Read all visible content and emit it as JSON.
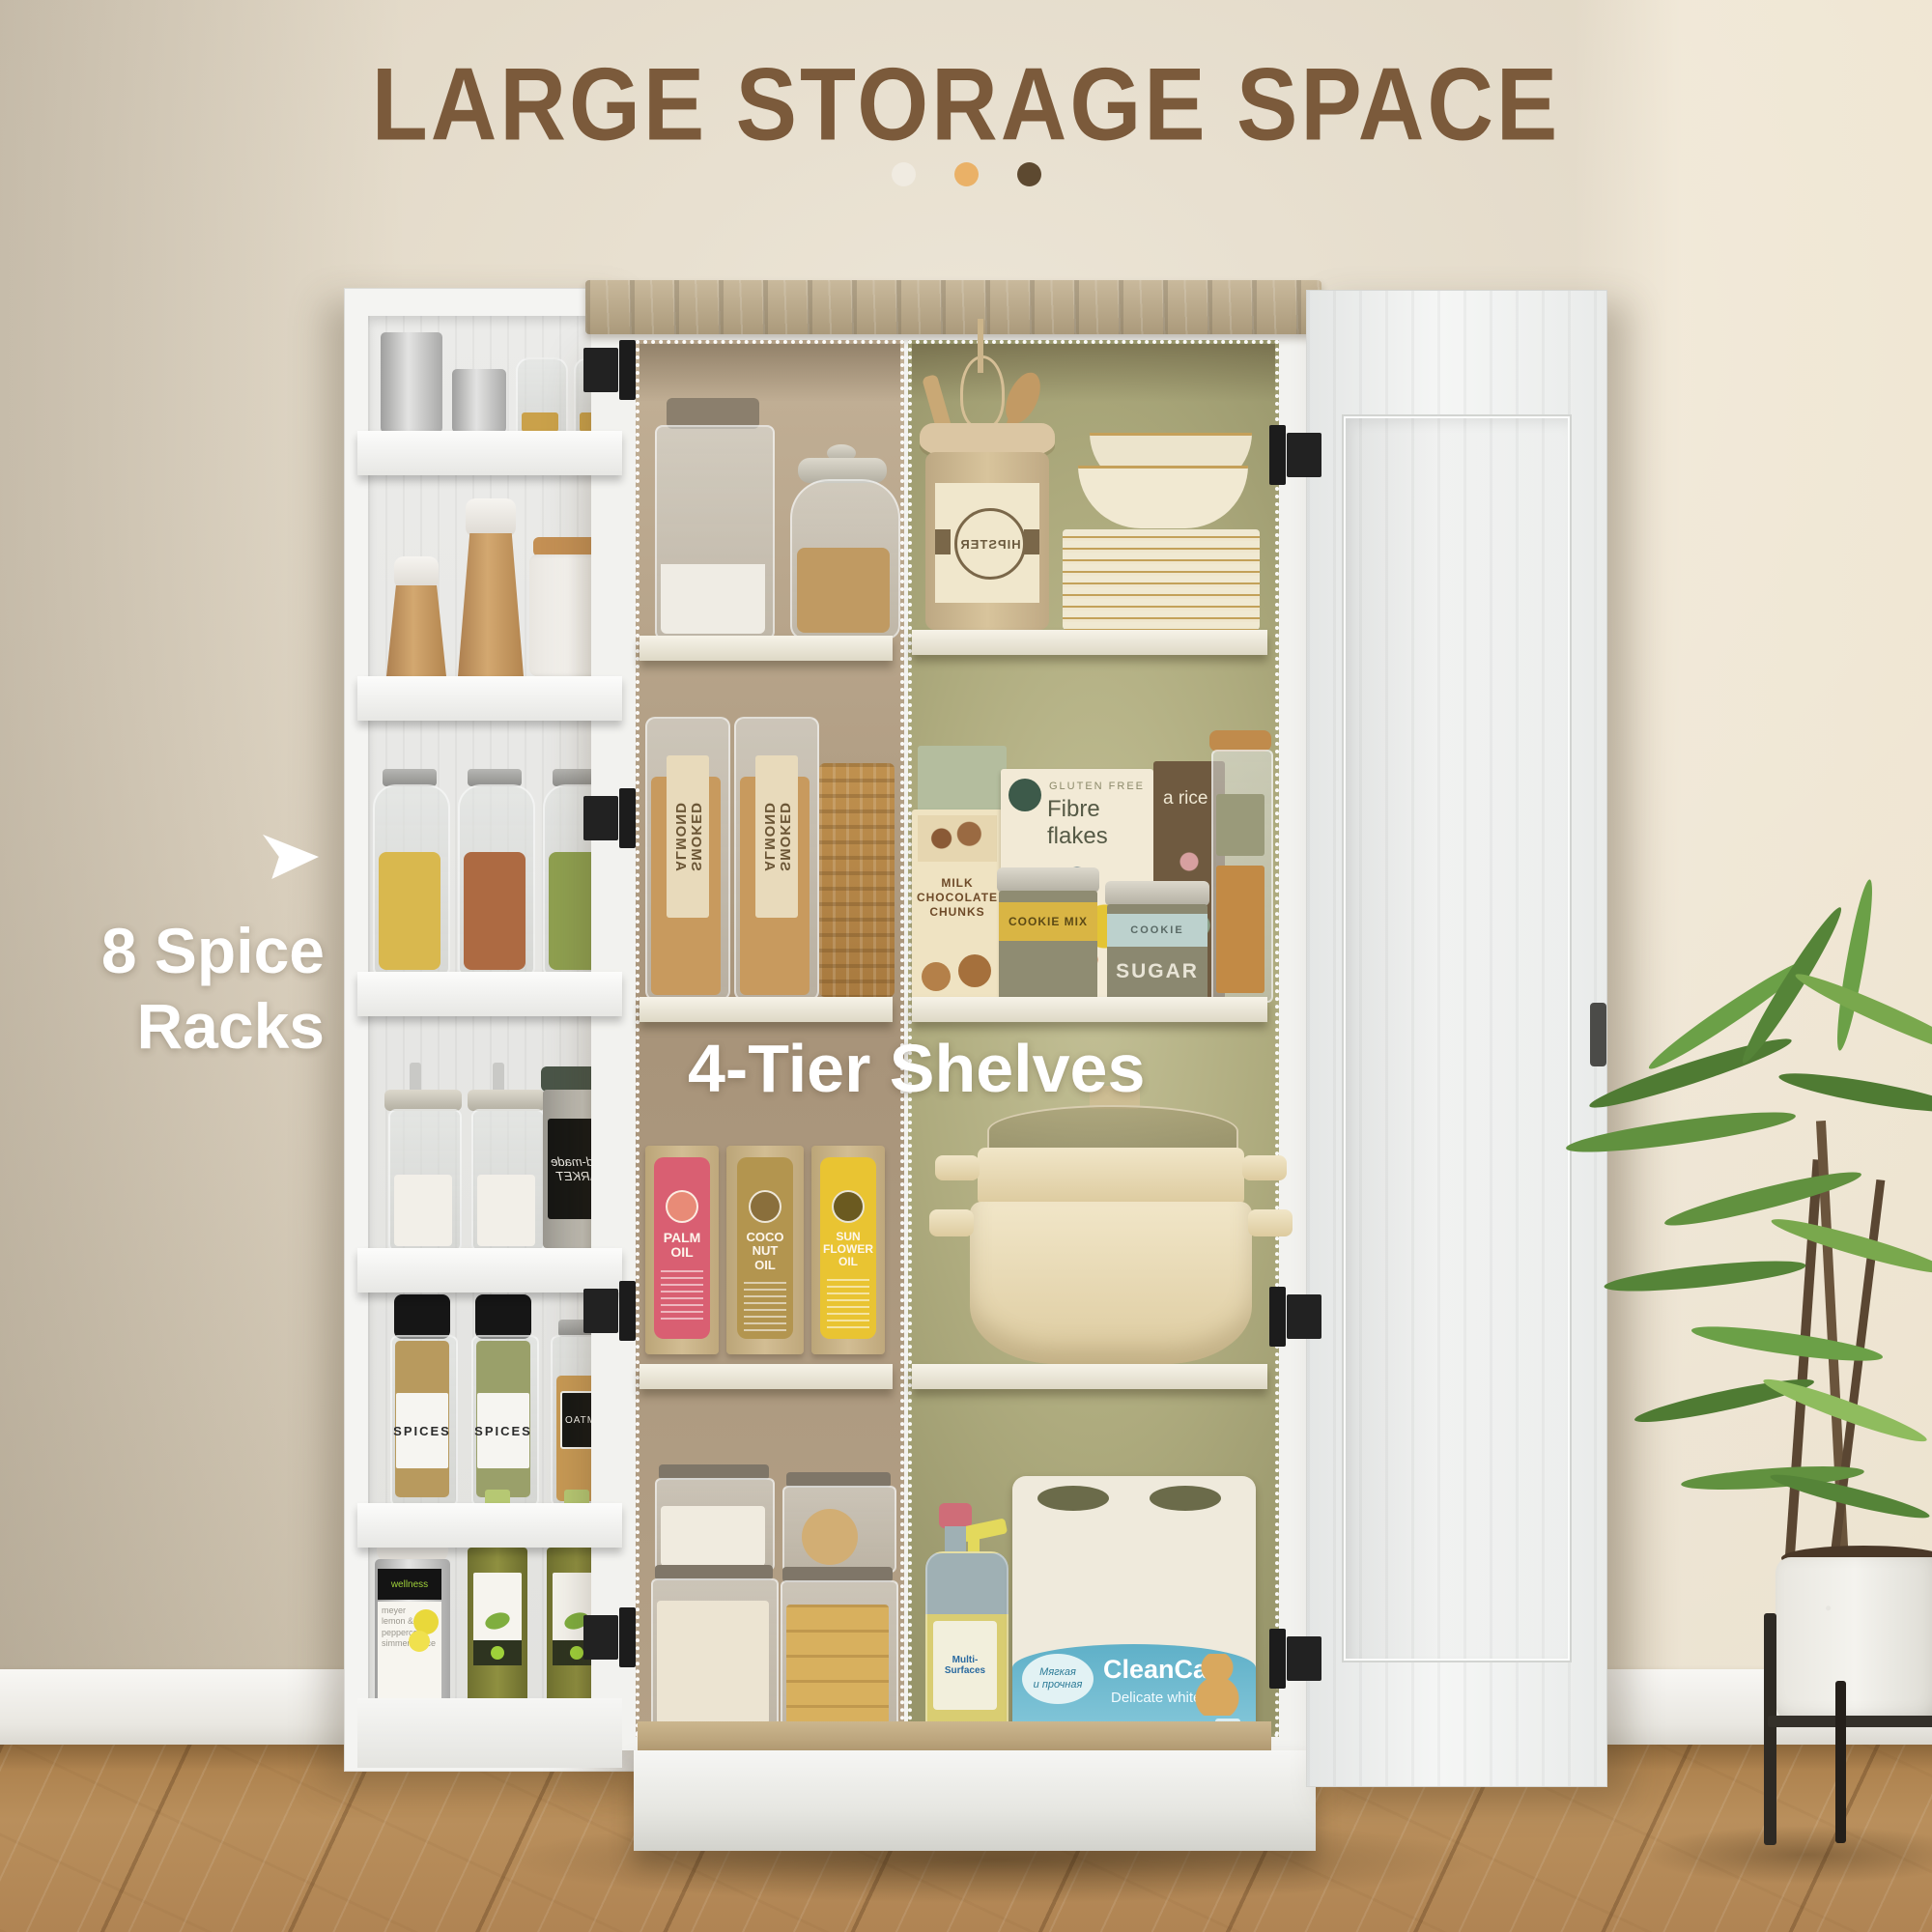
{
  "header": {
    "title": "LARGE STORAGE SPACE",
    "dot_colors": [
      "#f0ebe1",
      "#eab167",
      "#5d4930"
    ]
  },
  "callouts": {
    "spice_racks": "8 Spice\nRacks",
    "tier_shelves": "4-Tier Shelves"
  },
  "palette": {
    "wall": "#ddd3c1",
    "title_brown": "#7b5a3b",
    "floor_wood": "#b1874f",
    "interior_left_wood": "#ab9880",
    "interior_right_olive": "#aaa87c",
    "cabinet_white": "#f2f2ef",
    "hinge_black": "#1c1c1c"
  },
  "spice_rack": {
    "shelf_count": 6,
    "shelves": [
      {
        "items": [
          "steel canister",
          "small steel canister",
          "glass shaker jar",
          "glass shaker jar"
        ]
      },
      {
        "items": [
          "tall wooden pepper mill",
          "small wooden pepper mill",
          "white ceramic clip jar"
        ]
      },
      {
        "items": [
          "clip jar of pasta",
          "clip jar of macaroni",
          "clip jar of green beans"
        ]
      },
      {
        "items": [
          "glass sugar dispenser",
          "glass sugar dispenser",
          "hand-made market tin"
        ]
      },
      {
        "items": [
          "spice grinder bottle",
          "spice grinder bottle",
          "oatmeal clip jar"
        ]
      },
      {
        "items": [
          "lemon simmer sauce jar",
          "olive oil bottle",
          "olive oil bottle"
        ]
      }
    ],
    "labels": {
      "hand_made": "hand-made\nMARKET",
      "spices_1": "SPICES",
      "spices_2": "SPICES",
      "oatmeal": "OATMEAL",
      "wellness": "wellness",
      "simmer_sauce": "meyer\nlemon &\npeppercorn\nsimmer sauce"
    }
  },
  "pantry": {
    "left_column": {
      "tiers": [
        {
          "items": [
            "glass canister of flour",
            "fluted jar of oats"
          ]
        },
        {
          "items": [
            "jar of smoked almonds",
            "jar of smoked almonds",
            "wicker basket"
          ],
          "almond_label": "SMOKED\nALMOND"
        },
        {
          "items": [
            "palm oil box",
            "coconut oil box",
            "sunflower oil box"
          ],
          "palm": "PALM\nOIL",
          "coconut": "COCO\nNUT\nOIL",
          "sunflower": "SUN\nFLOWER\nOIL"
        },
        {
          "items": [
            "container of flour",
            "container of rice",
            "container of cookies",
            "container of wafer rolls"
          ]
        }
      ]
    },
    "right_column": {
      "tiers": [
        {
          "items": [
            "utensil crock with whisk and spoons",
            "stack of gold-rim plates",
            "gold-rim bowls"
          ],
          "hipster": "HIPSTER"
        },
        {
          "items": [
            "cereal box",
            "rice box",
            "chocolate box",
            "cookie mix tin",
            "sugar tin",
            "jar of grains"
          ],
          "gluten_free": "GLUTEN FREE",
          "fibre_flakes": "Fibre flakes",
          "rice": "a rice",
          "milk_chocolate": "MILK\nCHOCOLATE\nCHUNKS",
          "cookie_mix": "COOKIE MIX",
          "cookie": "COOKIE",
          "sugar": "SUGAR"
        },
        {
          "items": [
            "cream steamer pot with glass lid"
          ]
        },
        {
          "items": [
            "multi-surface spray bottle",
            "paper towel 4-pack"
          ],
          "multi_surfaces": "Multi-Surfaces",
          "cleancare": "CleanCare",
          "delicate_white": "Delicate white",
          "ru_tagline": "Мягкая\nи прочная",
          "pack_counts": "4  2"
        }
      ]
    }
  },
  "plant": {
    "description": "potted palm in white speckled planter on black wood stand"
  }
}
